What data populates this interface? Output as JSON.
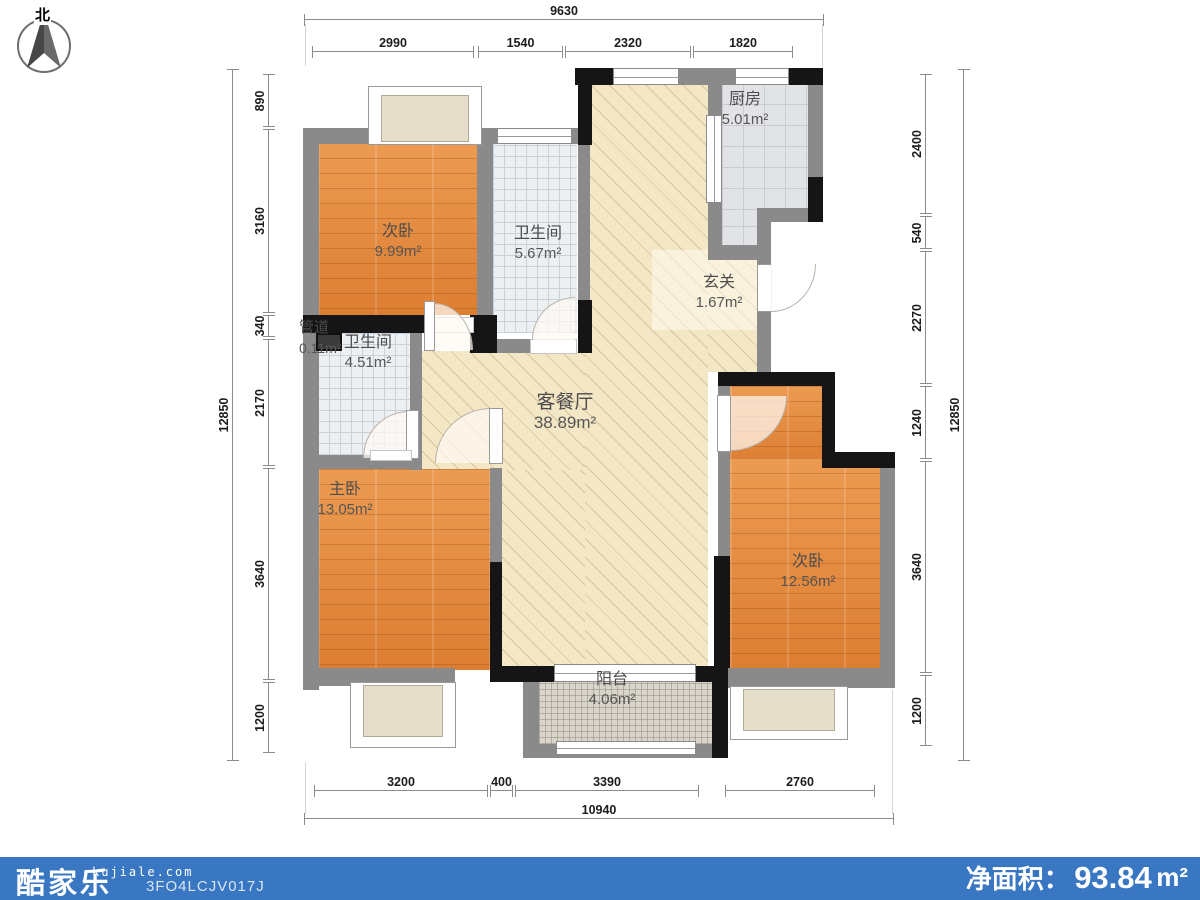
{
  "compass": {
    "north_label": "北"
  },
  "rooms": {
    "kitchen": {
      "name": "厨房",
      "area": "5.01m²"
    },
    "bedroom_tl": {
      "name": "次卧",
      "area": "9.99m²"
    },
    "bath_top": {
      "name": "卫生间",
      "area": "5.67m²"
    },
    "entry": {
      "name": "玄关",
      "area": "1.67m²"
    },
    "duct": {
      "name": "管道",
      "area": "0.11m²"
    },
    "bath_mid": {
      "name": "卫生间",
      "area": "4.51m²"
    },
    "living": {
      "name": "客餐厅",
      "area": "38.89m²"
    },
    "master": {
      "name": "主卧",
      "area": "13.05m²"
    },
    "bedroom_r": {
      "name": "次卧",
      "area": "12.56m²"
    },
    "balcony": {
      "name": "阳台",
      "area": "4.06m²"
    }
  },
  "dimensions": {
    "top": {
      "overall": "9630",
      "segments": [
        "2990",
        "1540",
        "2320",
        "1820"
      ]
    },
    "bottom": {
      "overall": "10940",
      "segments": [
        "3200",
        "400",
        "3390",
        "2760"
      ]
    },
    "left": {
      "overall": "12850",
      "segments": [
        "890",
        "3160",
        "340",
        "2170",
        "3640",
        "1200"
      ]
    },
    "right": {
      "overall": "12850",
      "segments": [
        "2400",
        "540",
        "2270",
        "1240",
        "3640",
        "1200"
      ]
    }
  },
  "footer": {
    "logo": "酷家乐",
    "website": "kujiale.com",
    "plan_code": "3FO4LCJV017J",
    "net_area_label": "净面积：",
    "net_area_value": "93.84",
    "net_area_unit": "m²",
    "bar_color": "#3a77c3"
  },
  "colors": {
    "wall_gray": "#8a8a8a",
    "wall_black": "#151515",
    "wood_floor": "#e2873d",
    "living_floor": "#f4e7c6",
    "bath_floor": "#edf0f3",
    "kitchen_floor": "#e2e3e6",
    "balcony_floor": "#d9d5cb"
  }
}
